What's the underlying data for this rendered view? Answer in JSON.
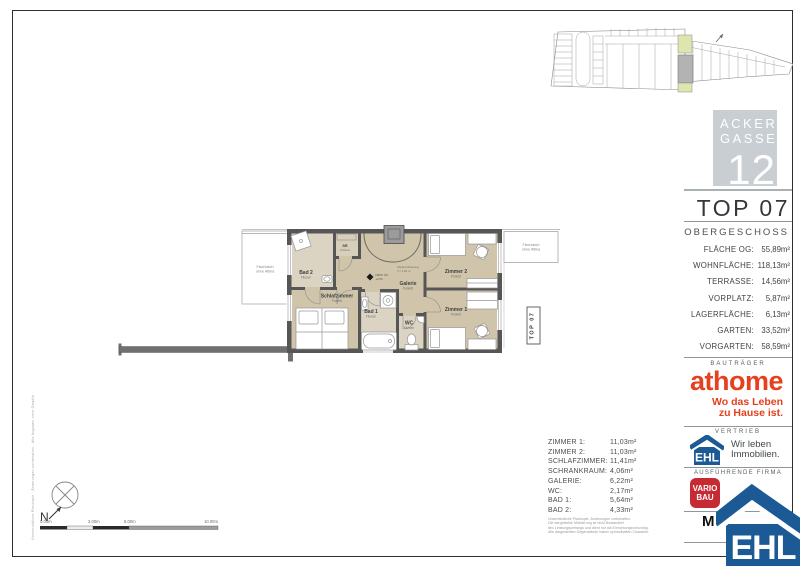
{
  "header": {
    "unit": "TOP 07",
    "floor": "OBERGESCHOSS"
  },
  "branding": {
    "ackergasse": {
      "line1": "ACKER",
      "line2": "GASSE",
      "number": "12"
    },
    "athome": {
      "name": "athome",
      "tagline_line1": "Wo das Leben",
      "tagline_line2": "zu Hause ist."
    },
    "ehl": {
      "name": "EHL",
      "slogan_line1": "Wir leben",
      "slogan_line2": "Immobilien."
    },
    "vario": {
      "line1": "VARIO",
      "line2": "BAU"
    },
    "m_logo": "M",
    "ehl_large": "EHL"
  },
  "sections": {
    "bautraeger": "BAUTRÄGER",
    "vertrieb": "VERTRIEB",
    "ausfuehrende_firma": "AUSFÜHRENDE FIRMA"
  },
  "areas": [
    {
      "label": "FLÄCHE OG:",
      "value": "55,89m²"
    },
    {
      "label": "WOHNFLÄCHE:",
      "value": "118,13m²"
    },
    {
      "label": "TERRASSE:",
      "value": "14,56m²"
    },
    {
      "label": "VORPLATZ:",
      "value": "5,87m²"
    },
    {
      "label": "LAGERFLÄCHE:",
      "value": "6,13m²"
    },
    {
      "label": "GARTEN:",
      "value": "33,52m²"
    },
    {
      "label": "VORGARTEN:",
      "value": "58,59m²"
    }
  ],
  "room_table": [
    {
      "label": "ZIMMER 1:",
      "value": "11,03m²"
    },
    {
      "label": "ZIMMER 2:",
      "value": "11,03m²"
    },
    {
      "label": "SCHLAFZIMMER:",
      "value": "11,41m²"
    },
    {
      "label": "SCHRANKRAUM:",
      "value": "4,06m²"
    },
    {
      "label": "GALERIE:",
      "value": "6,22m²"
    },
    {
      "label": "WC:",
      "value": "2,17m²"
    },
    {
      "label": "BAD 1:",
      "value": "5,64m²"
    },
    {
      "label": "BAD 2:",
      "value": "4,33m²"
    }
  ],
  "plan": {
    "rooms": [
      {
        "label": "Bad 2",
        "floor": "Fliesen"
      },
      {
        "label": "SR",
        "floor": "Parkett"
      },
      {
        "label": "Schlafzimmer",
        "floor": "Parkett"
      },
      {
        "label": "Galerie",
        "floor": "Parkett"
      },
      {
        "label": "Bad 1",
        "floor": "Fliesen"
      },
      {
        "label": "WC",
        "floor": "Fliesen"
      },
      {
        "label": "Zimmer 2",
        "floor": "Parkett"
      },
      {
        "label": "Zimmer 1",
        "floor": "Parkett"
      }
    ],
    "flachdach": {
      "line1": "Flachdach",
      "line2": "ohne Attika"
    },
    "unit_tag": "TOP 07",
    "level_marker": {
      "line1": "FBOK OG",
      "line2": "+2,53"
    },
    "railing_note": {
      "line1": "Absturzsicherung",
      "line2": "h = 1,00 m"
    }
  },
  "footer": {
    "disclaimer": [
      "Unverbindliche Plankopie. Änderungen vorbehalten.",
      "Die dargestellte Möblierung ist nicht Bestandteil",
      "des Leistungsumfangs und dient nur als Einrichtungsvorschlag.",
      "Alle dargestellten Gegenstände haben symbolhaften Charakter."
    ],
    "margin_note": "Unverbindliche Plankopie · Änderungen vorbehalten · Alle Angaben ohne Gewähr",
    "scalebar_labels": [
      "0.00m",
      "3.00m",
      "5.00m",
      "10.00m"
    ],
    "compass_north": "N"
  },
  "colors": {
    "athome_red": "#E6401F",
    "ehl_blue": "#1C5A96",
    "vario_red": "#C62A33",
    "wall_gray": "#565656",
    "room_tan": "#D0C5AA",
    "wet_room_tan": "#DCD4C2",
    "siteplan_highlight_gray": "#B3B3B3",
    "siteplan_highlight_green": "#DFE5AF",
    "acker_box_gray": "#C9CED2"
  }
}
